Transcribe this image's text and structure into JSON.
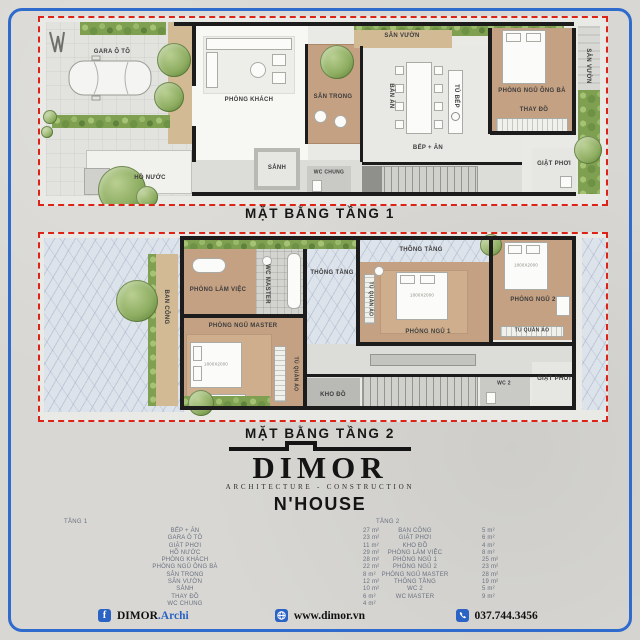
{
  "colors": {
    "frame_blue": "#2f6bcc",
    "boundary_red": "#dd2318",
    "footer_blue": "#2b63c4"
  },
  "plan1": {
    "title": "MẶT BẰNG TẦNG 1",
    "labels": {
      "gara": "GARA Ô TÔ",
      "ho_nuoc": "HỒ NƯỚC",
      "phong_khach": "PHÒNG KHÁCH",
      "sanh": "SẢNH",
      "wc_chung": "WC CHUNG",
      "san_trong": "SÂN TRONG",
      "san_vuon_top": "SÂN VƯỜN",
      "ban_an": "BÀN ĂN",
      "bep_an": "BẾP + ĂN",
      "tu_bep": "TỦ BẾP",
      "phong_ngu_ong_ba": "PHÒNG NGỦ ÔNG BÀ",
      "thay_do": "THAY ĐỒ",
      "giat_phoi": "GIẶT PHƠI",
      "san_vuon_right": "SÂN VƯỜN"
    }
  },
  "plan2": {
    "title": "MẶT BẰNG TẦNG 2",
    "labels": {
      "ban_cong": "BAN CÔNG",
      "phong_lam_viec": "PHÒNG LÀM VIỆC",
      "wc_master": "WC MASTER",
      "phong_ngu_master": "PHÒNG NGỦ MASTER",
      "tu_quan_ao": "TỦ QUẦN ÁO",
      "thong_tang": "THÔNG TẦNG",
      "phong_ngu_1": "PHÒNG NGỦ 1",
      "phong_ngu_2": "PHÒNG NGỦ 2",
      "kho_do": "KHO ĐỒ",
      "wc_2": "WC 2",
      "giat_phoi": "GIẶT PHƠI",
      "bed_size": "1800X2000"
    }
  },
  "logo": {
    "brand": "DIMOR",
    "tagline": "ARCHITECTURE - CONSTRUCTION",
    "project": "N'HOUSE"
  },
  "tables": {
    "floor1": {
      "title": "TẦNG 1",
      "rows": [
        {
          "name": "BẾP + ĂN",
          "area": "27 m²"
        },
        {
          "name": "GARA Ô TÔ",
          "area": "23 m²"
        },
        {
          "name": "GIẶT PHƠI",
          "area": "11 m²"
        },
        {
          "name": "HỒ NƯỚC",
          "area": "29 m²"
        },
        {
          "name": "PHÒNG KHÁCH",
          "area": "28 m²"
        },
        {
          "name": "PHÒNG NGỦ ÔNG BÀ",
          "area": "22 m²"
        },
        {
          "name": "SÂN TRONG",
          "area": "8 m²"
        },
        {
          "name": "SÂN VƯỜN",
          "area": "12 m²"
        },
        {
          "name": "SẢNH",
          "area": "10 m²"
        },
        {
          "name": "THAY ĐỒ",
          "area": "6 m²"
        },
        {
          "name": "WC CHUNG",
          "area": "4 m²"
        }
      ]
    },
    "floor2": {
      "title": "TẦNG 2",
      "rows": [
        {
          "name": "BAN CÔNG",
          "area": "5 m²"
        },
        {
          "name": "GIẶT PHƠI",
          "area": "6 m²"
        },
        {
          "name": "KHO ĐỒ",
          "area": "4 m²"
        },
        {
          "name": "PHÒNG LÀM VIỆC",
          "area": "8 m²"
        },
        {
          "name": "PHÒNG NGỦ 1",
          "area": "25 m²"
        },
        {
          "name": "PHÒNG NGỦ 2",
          "area": "23 m²"
        },
        {
          "name": "PHÒNG NGỦ MASTER",
          "area": "28 m²"
        },
        {
          "name": "THÔNG TẦNG",
          "area": "19 m²"
        },
        {
          "name": "WC 2",
          "area": "5 m²"
        },
        {
          "name": "WC MASTER",
          "area": "9 m²"
        }
      ]
    }
  },
  "footer": {
    "facebook_glyph": "f",
    "facebook_brand": "DIMOR",
    "facebook_suffix": ".Archi",
    "website": "www.dimor.vn",
    "phone": "037.744.3456"
  }
}
